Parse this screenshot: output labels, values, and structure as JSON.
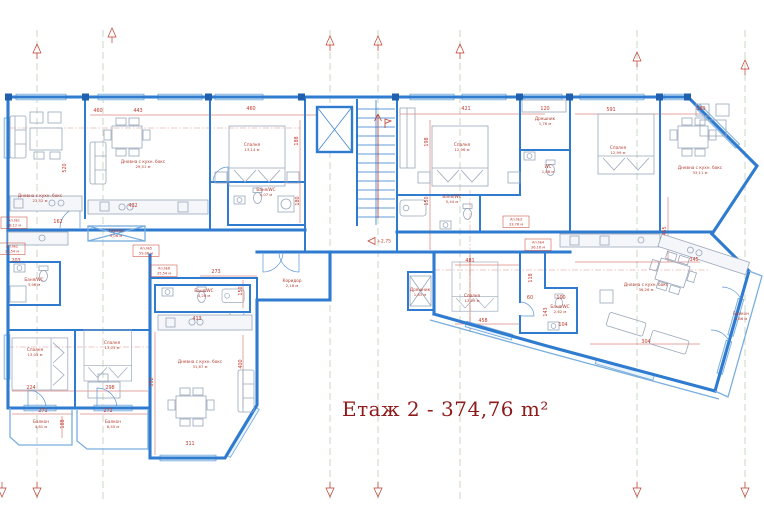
{
  "title": {
    "text": "Етаж 2 - 374,76 m²"
  },
  "level": {
    "t": "+2,75",
    "x": 368,
    "y": 241
  },
  "colors": {
    "wall": "#2e7bd0",
    "wall_dark": "#1f5fae",
    "dim_red": "#c23b2e",
    "title_red": "#8d1b1b",
    "axis_green": "#bccfb6",
    "furniture_gray": "#9aa7bb",
    "window_blue": "#79aede"
  },
  "rooms": [
    {
      "n": "Дневна с кухн. бокс",
      "a": "23,52 м",
      "x": 40,
      "y": 197
    },
    {
      "n": "Дневна с кухн. бокс",
      "a": "29,51 м",
      "x": 143,
      "y": 163
    },
    {
      "n": "Спалня",
      "a": "13,14 м",
      "x": 252,
      "y": 146
    },
    {
      "n": "Баня/WC",
      "a": "4,07 м",
      "x": 266,
      "y": 191
    },
    {
      "n": "Спалня",
      "a": "12,96 м",
      "x": 462,
      "y": 146
    },
    {
      "n": "Дрешник",
      "a": "1,76 м",
      "x": 545,
      "y": 120
    },
    {
      "n": "WC",
      "a": "1,88 м",
      "x": 548,
      "y": 168
    },
    {
      "n": "Баня/WC",
      "a": "5,44 м",
      "x": 452,
      "y": 198
    },
    {
      "n": "Спалня",
      "a": "12,99 м",
      "x": 618,
      "y": 149
    },
    {
      "n": "Дневна с кухн. бокс",
      "a": "33,11 м",
      "x": 700,
      "y": 169
    },
    {
      "n": "Баня/WC",
      "a": "3,96 м",
      "x": 34,
      "y": 281
    },
    {
      "n": "Тераса",
      "a": "5,06 м",
      "x": 116,
      "y": 232
    },
    {
      "n": "Коридор",
      "a": "2,18 м",
      "x": 292,
      "y": 282
    },
    {
      "n": "Баня/WC",
      "a": "4,28 м",
      "x": 204,
      "y": 292
    },
    {
      "n": "Дневна с кухн. бокс",
      "a": "31,67 м",
      "x": 200,
      "y": 363
    },
    {
      "n": "Спалня",
      "a": "13,05 м",
      "x": 35,
      "y": 351
    },
    {
      "n": "Спалня",
      "a": "13,01 м",
      "x": 112,
      "y": 344
    },
    {
      "n": "Спалня",
      "a": "13,09 м",
      "x": 472,
      "y": 297
    },
    {
      "n": "Дрешник",
      "a": "1,83 м",
      "x": 420,
      "y": 291
    },
    {
      "n": "Баня/WC",
      "a": "2,62 м",
      "x": 560,
      "y": 308
    },
    {
      "n": "Дневна с кухн. бокс",
      "a": "36,26 м",
      "x": 646,
      "y": 286
    },
    {
      "n": "Балкон",
      "a": "4,86 м",
      "x": 741,
      "y": 315
    },
    {
      "n": "Балкон",
      "a": "4,61 м",
      "x": 41,
      "y": 423
    },
    {
      "n": "Балкон",
      "a": "6,45 м",
      "x": 113,
      "y": 423
    }
  ],
  "dims": [
    {
      "t": "460",
      "x": 98,
      "y": 112
    },
    {
      "t": "443",
      "x": 138,
      "y": 112
    },
    {
      "t": "460",
      "x": 251,
      "y": 110
    },
    {
      "t": "421",
      "x": 466,
      "y": 110
    },
    {
      "t": "120",
      "x": 545,
      "y": 110
    },
    {
      "t": "591",
      "x": 611,
      "y": 111
    },
    {
      "t": "189",
      "x": 701,
      "y": 110
    },
    {
      "t": "520",
      "x": 66,
      "y": 168,
      "r": 1
    },
    {
      "t": "188",
      "x": 298,
      "y": 141,
      "r": 1
    },
    {
      "t": "180",
      "x": 299,
      "y": 201,
      "r": 1
    },
    {
      "t": "198",
      "x": 428,
      "y": 142,
      "r": 1
    },
    {
      "t": "150",
      "x": 428,
      "y": 201,
      "r": 1
    },
    {
      "t": "455",
      "x": 666,
      "y": 231,
      "r": 1
    },
    {
      "t": "432",
      "x": 133,
      "y": 207
    },
    {
      "t": "162",
      "x": 58,
      "y": 223
    },
    {
      "t": "203",
      "x": 16,
      "y": 262
    },
    {
      "t": "273",
      "x": 216,
      "y": 273
    },
    {
      "t": "150",
      "x": 242,
      "y": 291,
      "r": 1
    },
    {
      "t": "413",
      "x": 197,
      "y": 320
    },
    {
      "t": "400",
      "x": 242,
      "y": 364,
      "r": 1
    },
    {
      "t": "592",
      "x": 153,
      "y": 382,
      "r": 1
    },
    {
      "t": "481",
      "x": 470,
      "y": 262
    },
    {
      "t": "118",
      "x": 532,
      "y": 278,
      "r": 1
    },
    {
      "t": "458",
      "x": 483,
      "y": 322
    },
    {
      "t": "60",
      "x": 530,
      "y": 299
    },
    {
      "t": "100",
      "x": 561,
      "y": 299
    },
    {
      "t": "143",
      "x": 547,
      "y": 312,
      "r": 1
    },
    {
      "t": "104",
      "x": 563,
      "y": 326
    },
    {
      "t": "345",
      "x": 694,
      "y": 261
    },
    {
      "t": "304",
      "x": 646,
      "y": 343
    },
    {
      "t": "224",
      "x": 31,
      "y": 389
    },
    {
      "t": "298",
      "x": 110,
      "y": 389
    },
    {
      "t": "271",
      "x": 43,
      "y": 412
    },
    {
      "t": "272",
      "x": 108,
      "y": 412
    },
    {
      "t": "188",
      "x": 64,
      "y": 424,
      "r": 1
    },
    {
      "t": "311",
      "x": 190,
      "y": 445
    }
  ],
  "tags": [
    {
      "n": "Ап.№1",
      "s": "38,12 м",
      "x": 14,
      "y": 222
    },
    {
      "n": "Ап.№2",
      "s": "30,54 м",
      "x": 12,
      "y": 248
    },
    {
      "n": "Ап.№5",
      "s": "59,06 м",
      "x": 146,
      "y": 250
    },
    {
      "n": "Ап.№6",
      "s": "35,54 м",
      "x": 164,
      "y": 270
    },
    {
      "n": "Ап.№3",
      "s": "33,76 м",
      "x": 516,
      "y": 221
    },
    {
      "n": "Ап.№4",
      "s": "36,16 м",
      "x": 538,
      "y": 244
    }
  ],
  "axes": {
    "lines": [
      37,
      103,
      330,
      378,
      460,
      637,
      745
    ],
    "top": [
      {
        "x": 37,
        "y": 44
      },
      {
        "x": 112,
        "y": 28
      },
      {
        "x": 330,
        "y": 36
      },
      {
        "x": 378,
        "y": 36
      },
      {
        "x": 460,
        "y": 44
      },
      {
        "x": 637,
        "y": 52
      },
      {
        "x": 745,
        "y": 60
      }
    ],
    "bottom": [
      {
        "x": 2,
        "y": 497
      },
      {
        "x": 37,
        "y": 497
      },
      {
        "x": 330,
        "y": 497
      },
      {
        "x": 378,
        "y": 497
      },
      {
        "x": 637,
        "y": 497
      },
      {
        "x": 745,
        "y": 497
      }
    ]
  }
}
